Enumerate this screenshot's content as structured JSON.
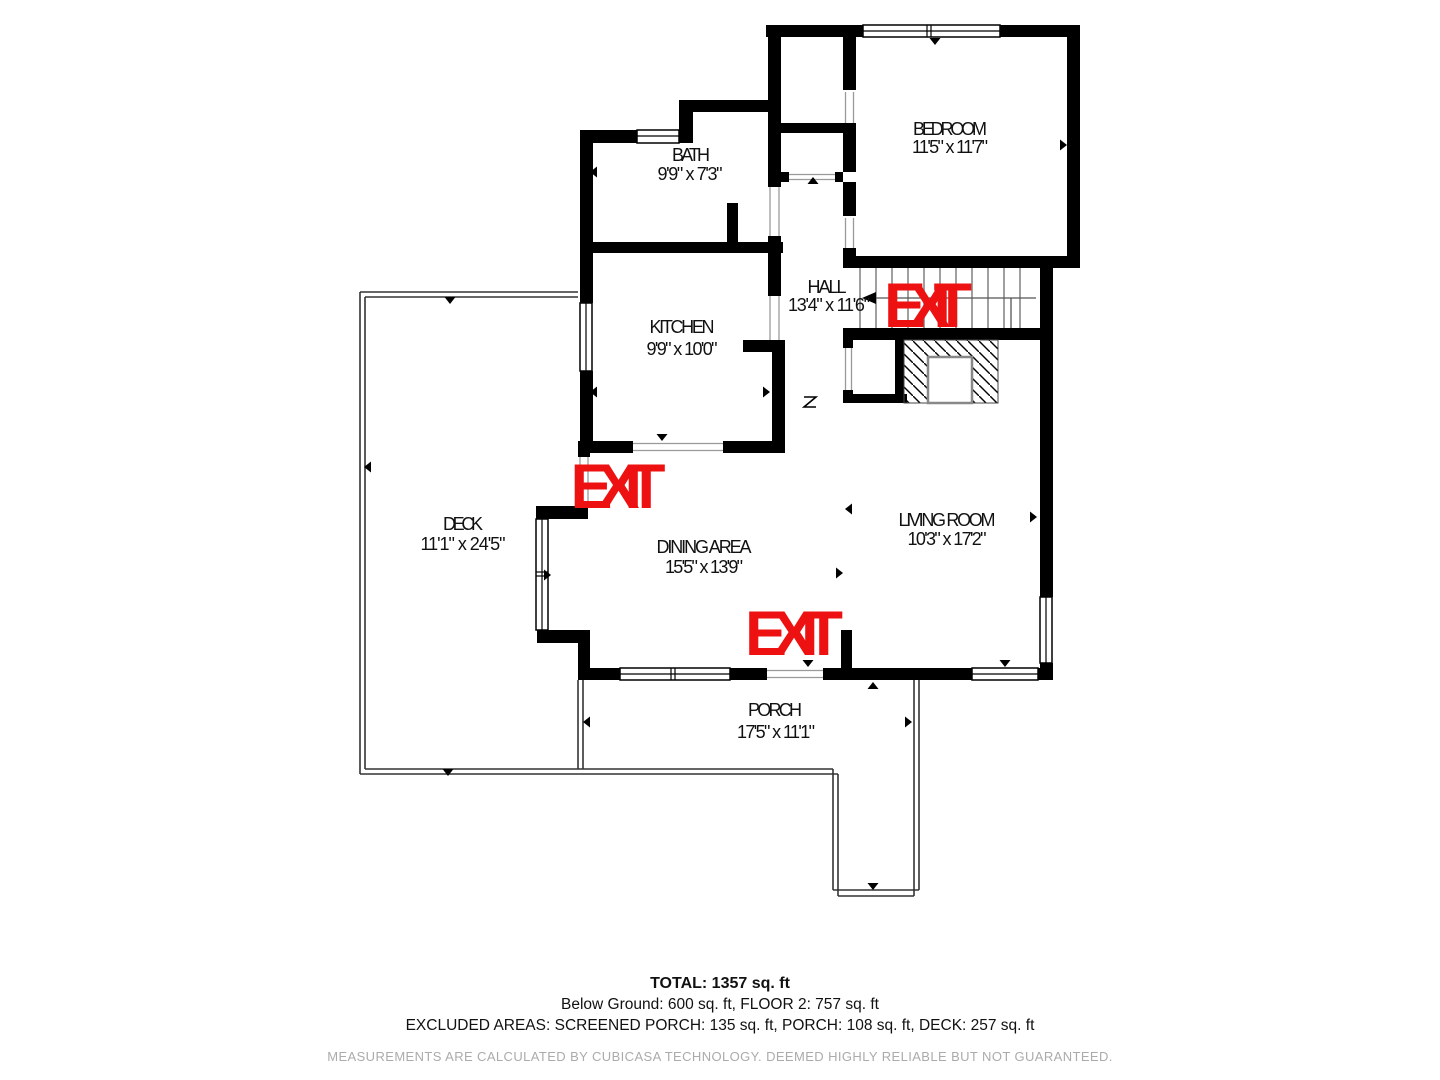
{
  "rooms": {
    "bath": {
      "name": "BATH",
      "dims": "9'9\" x 7'3\""
    },
    "kitchen": {
      "name": "KITCHEN",
      "dims": "9'9\" x 10'0\""
    },
    "bedroom": {
      "name": "BEDROOM",
      "dims": "11'5\" x 11'7\""
    },
    "hall": {
      "name": "HALL",
      "dims": "13'4\" x 11'6\""
    },
    "deck": {
      "name": "DECK",
      "dims": "11'1\" x 24'5\""
    },
    "dining": {
      "name": "DINING AREA",
      "dims": "15'5\" x 13'9\""
    },
    "living": {
      "name": "LIVING ROOM",
      "dims": "10'3\" x 17'2\""
    },
    "porch": {
      "name": "PORCH",
      "dims": "17'5\" x 11'1\""
    }
  },
  "exits": {
    "hall": "EXIT",
    "deck": "EXIT",
    "porch": "EXIT"
  },
  "footer": {
    "total": "TOTAL: 1357 sq. ft",
    "floors": "Below Ground: 600 sq. ft, FLOOR 2: 757 sq. ft",
    "excluded": "EXCLUDED AREAS: SCREENED PORCH: 135 sq. ft, PORCH: 108 sq. ft, DECK: 257 sq. ft",
    "disclaimer": "MEASUREMENTS ARE CALCULATED BY CUBICASA TECHNOLOGY. DEEMED HIGHLY RELIABLE BUT NOT GUARANTEED."
  },
  "colors": {
    "wall": "#000000",
    "exit": "#ee1111",
    "disclaimer": "#ababab"
  }
}
